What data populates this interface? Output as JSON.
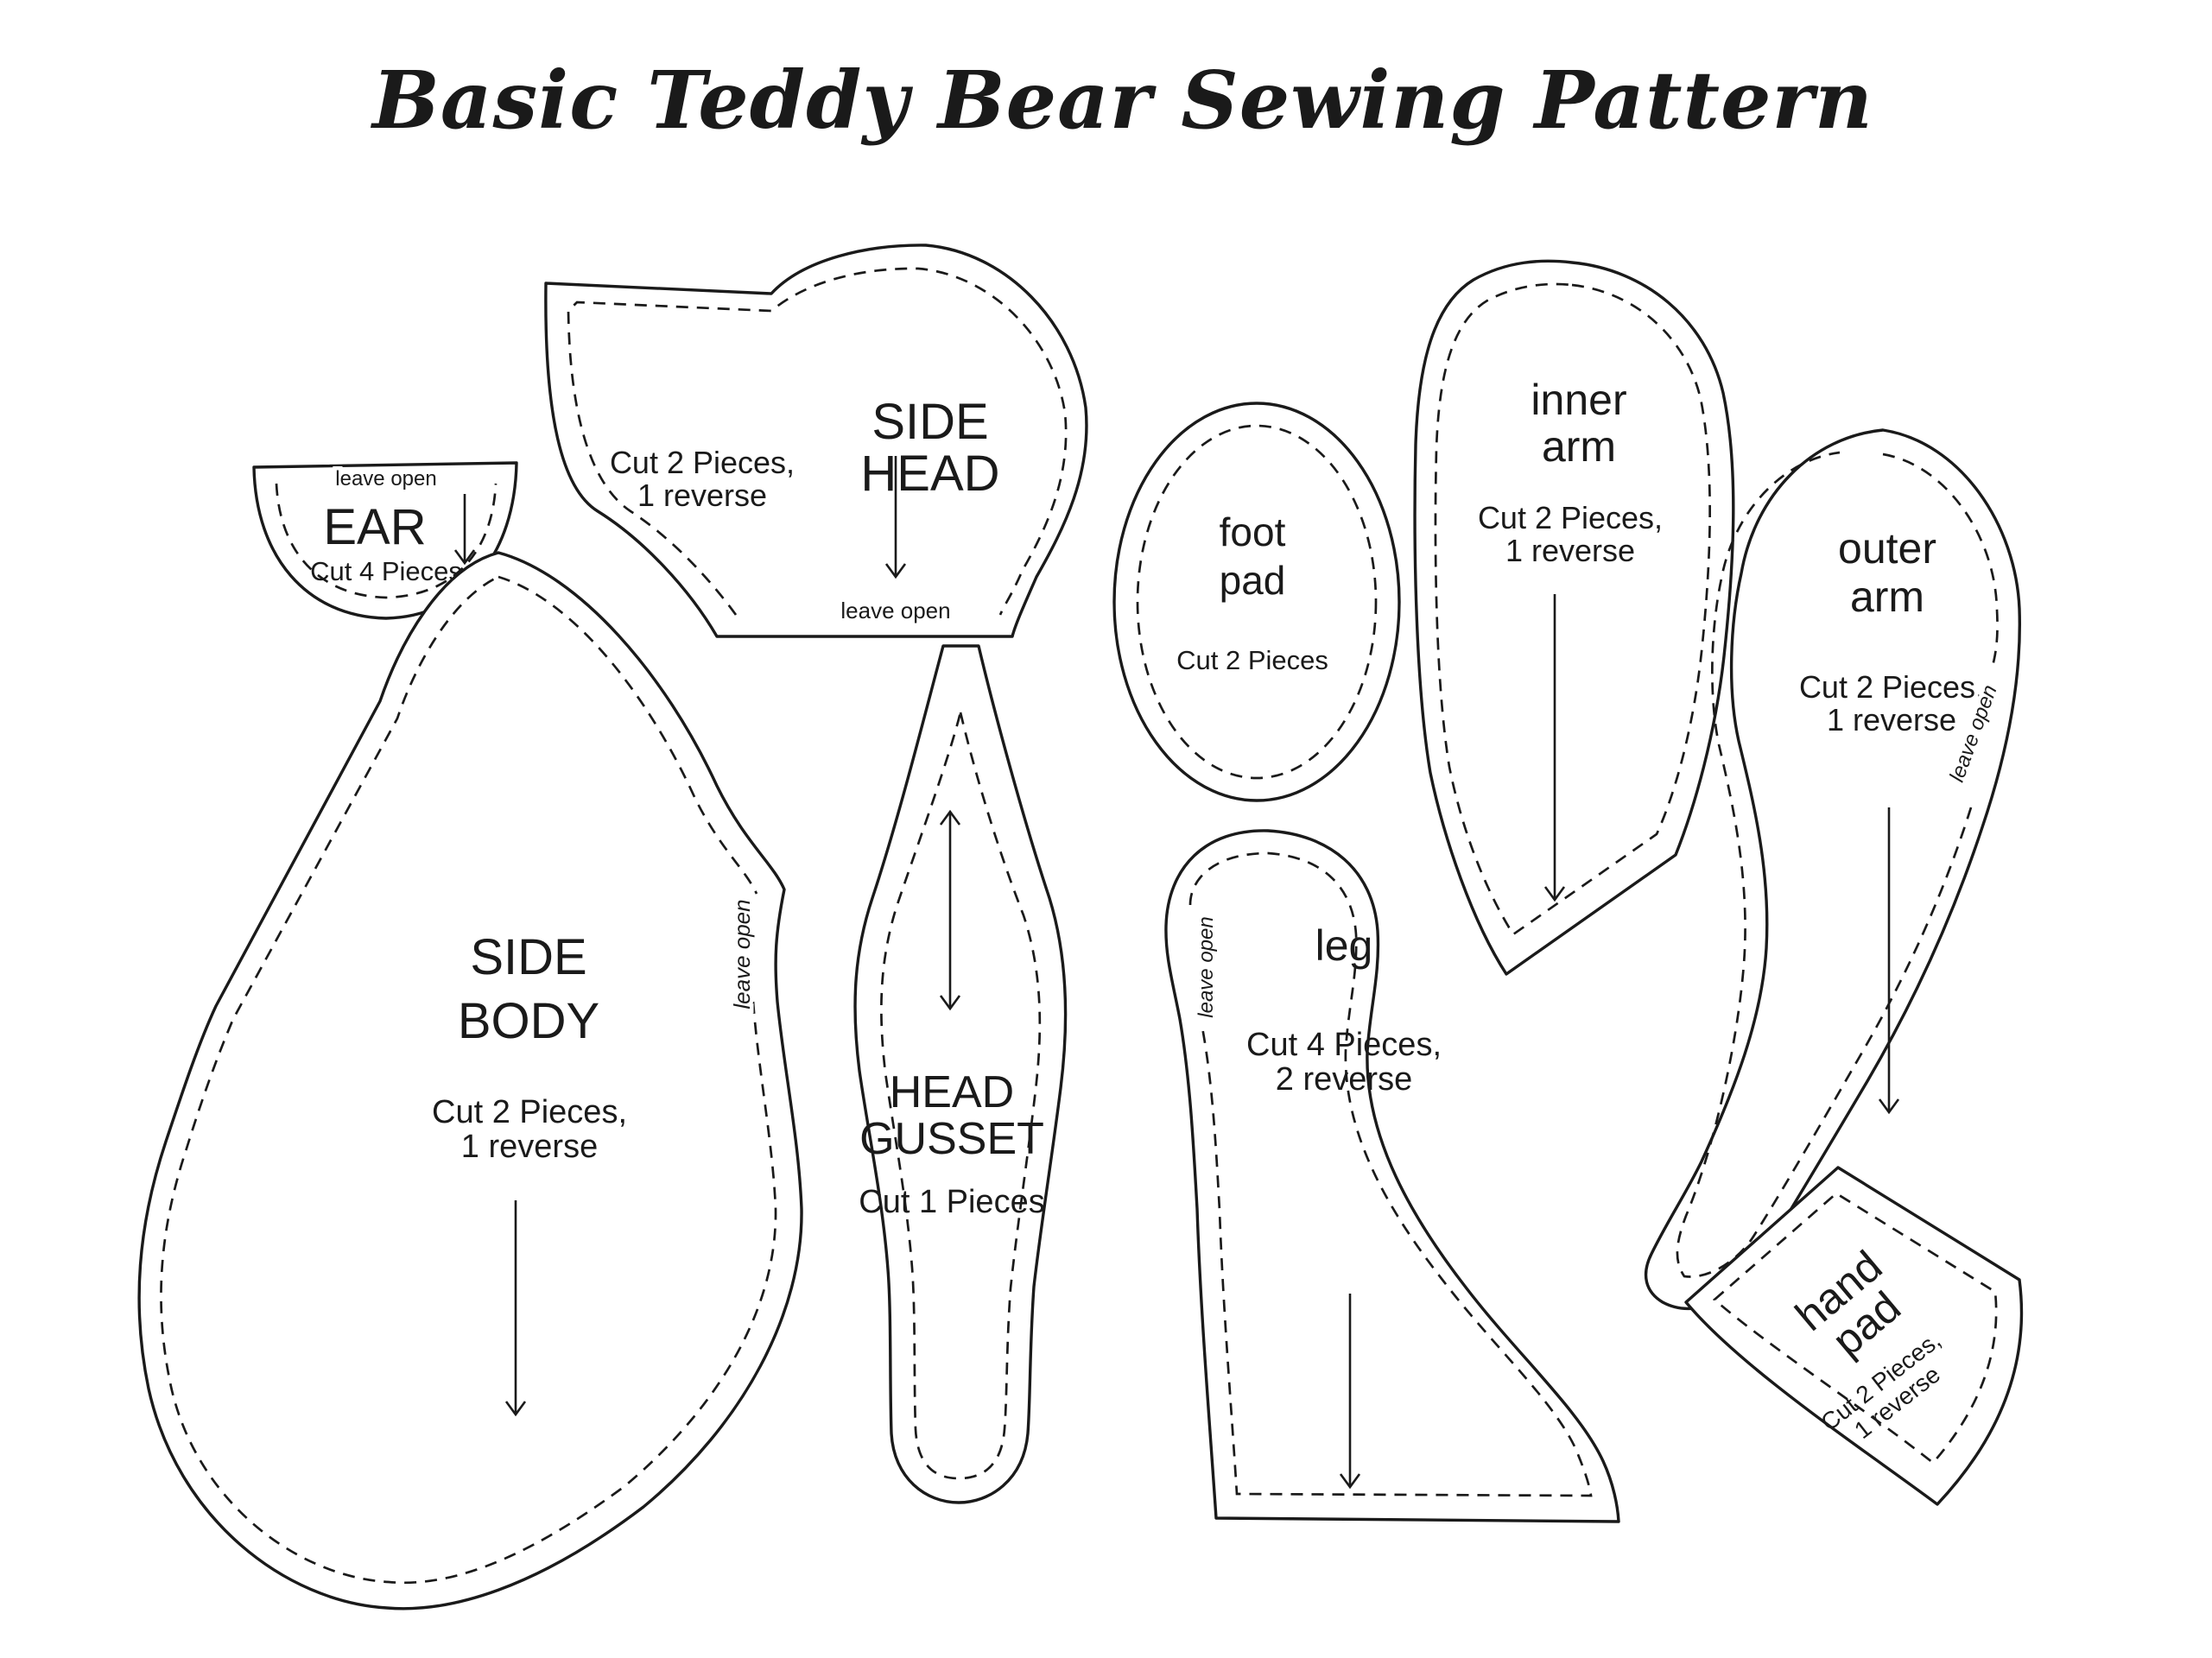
{
  "title": "Basic Teddy Bear Sewing Pattern",
  "colors": {
    "line": "#1a1a1a",
    "background": "#ffffff"
  },
  "pieces": {
    "ear": {
      "name": "EAR",
      "cut": "Cut 4 Pieces",
      "note": "leave open"
    },
    "side_head": {
      "name_line1": "SIDE",
      "name_line2": "HEAD",
      "cut_line1": "Cut 2 Pieces,",
      "cut_line2": "1 reverse",
      "note": "leave open"
    },
    "side_body": {
      "name_line1": "SIDE",
      "name_line2": "BODY",
      "cut_line1": "Cut 2 Pieces,",
      "cut_line2": "1 reverse",
      "note": "leave open"
    },
    "head_gusset": {
      "name_line1": "HEAD",
      "name_line2": "GUSSET",
      "cut": "Cut 1 Pieces"
    },
    "foot_pad": {
      "name_line1": "foot",
      "name_line2": "pad",
      "cut": "Cut 2 Pieces"
    },
    "leg": {
      "name": "leg",
      "cut_line1": "Cut 4 Pieces,",
      "cut_line2": "2 reverse",
      "note": "leave open"
    },
    "inner_arm": {
      "name_line1": "inner",
      "name_line2": "arm",
      "cut_line1": "Cut 2 Pieces,",
      "cut_line2": "1 reverse"
    },
    "outer_arm": {
      "name_line1": "outer",
      "name_line2": "arm",
      "cut_line1": "Cut 2 Pieces,",
      "cut_line2": "1 reverse",
      "note": "leave open"
    },
    "hand_pad": {
      "name_line1": "hand",
      "name_line2": "pad",
      "cut_line1": "Cut 2 Pieces,",
      "cut_line2": "1 reverse"
    }
  }
}
